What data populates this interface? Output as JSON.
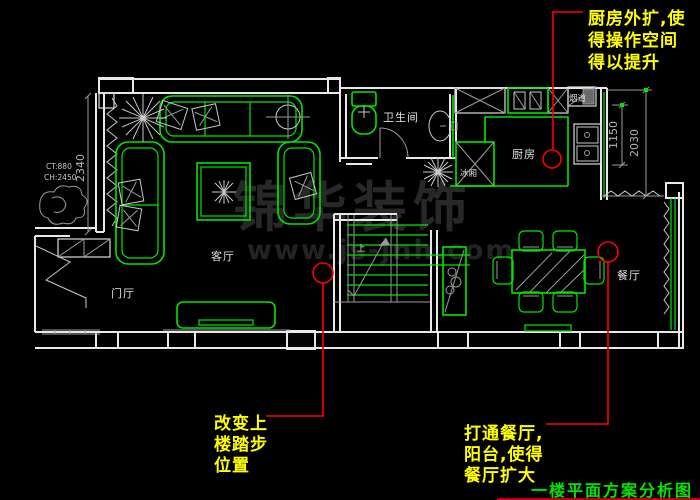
{
  "colors": {
    "background": "#000000",
    "wall_white": "#e8e8e8",
    "furniture_green": "#00e600",
    "annotation_red": "#ff0000",
    "note_yellow": "#ffff00",
    "title_green": "#00e600",
    "detail_gray": "#9b9b9b"
  },
  "rooms": {
    "entry": "门厅",
    "living": "客厅",
    "bath": "卫生间",
    "kitchen": "厨房",
    "dining": "餐厅",
    "fridge": "冰厢",
    "flue": "烟道",
    "stairs_up": "上"
  },
  "dimensions": {
    "left_wall": "2340",
    "right_outer": "2030",
    "right_inner": "1150",
    "ct": "CT:880",
    "ch": "CH:2450"
  },
  "annotations": {
    "kitchen": {
      "lines": [
        "厨房外扩,使",
        "得操作空间",
        "得以提升"
      ]
    },
    "stairs": {
      "lines": [
        "改变上",
        "楼踏步",
        "位置"
      ]
    },
    "dining": {
      "lines": [
        "打通餐厅,",
        "阳台,使得",
        "餐厅扩大"
      ]
    }
  },
  "title": "一楼平面方案分析图",
  "watermark": {
    "name": "锦华装饰",
    "url": "www.js-jnh.com"
  }
}
